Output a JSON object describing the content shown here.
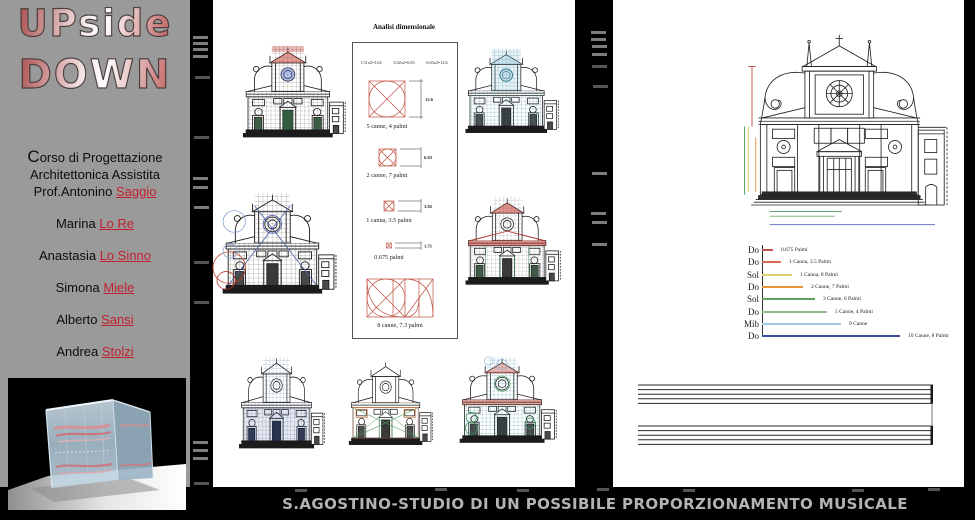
{
  "sidebar": {
    "logo": {
      "line1": "UPside",
      "line2": "DOWN"
    },
    "course": {
      "lead": "C",
      "line1_rest": "orso di Progettazione",
      "line2": "Architettonica Assistita",
      "line3_prefix": "Prof.Antonino ",
      "professor_link": "Saggio"
    },
    "members": [
      {
        "first": "Marina",
        "surname_link": "Lo Re"
      },
      {
        "first": "Anastasia",
        "surname_link": "Lo Sinno"
      },
      {
        "first": "Simona",
        "surname_link": "Miele"
      },
      {
        "first": "Alberto",
        "surname_link": "Sansi"
      },
      {
        "first": "Andrea",
        "surname_link": "Stolzi"
      }
    ]
  },
  "middle_panel": {
    "analysis_box": {
      "title": "Analisi dimensionale",
      "formulas": [
        "1.51x2=3.02",
        "3.02x2=6.03",
        "6.03x2=12.6"
      ],
      "items": [
        {
          "label": "5 canne, 4 palmi",
          "dim": "12.6"
        },
        {
          "label": "2 canne, 7 palmi",
          "dim": "6.03"
        },
        {
          "label": "1 canna, 3.5 palmi",
          "dim": "3.02"
        },
        {
          "label": "0.675 palmi",
          "dim": "1.51"
        },
        {
          "label": "8 canne, 7.3 palmi",
          "dim": ""
        }
      ]
    }
  },
  "right_panel": {
    "notes": {
      "rows": [
        {
          "note": "Do",
          "value": "0.675 Palmi",
          "color": "#c0504d",
          "length_px": 11
        },
        {
          "note": "Do",
          "value": "1 Canna, 3.5 Palmi",
          "color": "#d86a55",
          "length_px": 19
        },
        {
          "note": "Sol",
          "value": "1 Canna, 8 Palmi",
          "color": "#e0d470",
          "length_px": 30
        },
        {
          "note": "Do",
          "value": "2 Canne, 7 Palmi",
          "color": "#e8953a",
          "length_px": 41
        },
        {
          "note": "Sol",
          "value": "3 Canne, 6 Palmi",
          "color": "#5fa05c",
          "length_px": 53
        },
        {
          "note": "Do",
          "value": "5 Canne, 4 Palmi",
          "color": "#8fbc8f",
          "length_px": 65
        },
        {
          "note": "Mib",
          "value": "9 Canne",
          "color": "#9ecae8",
          "length_px": 79
        },
        {
          "note": "Do",
          "value": "10 Canne, 8 Palmi",
          "color": "#3b4ba0",
          "length_px": 138
        }
      ]
    }
  },
  "footer": {
    "caption": "S.AGOSTINO-STUDIO DI UN POSSIBILE PROPORZIONAMENTO MUSICALE"
  }
}
